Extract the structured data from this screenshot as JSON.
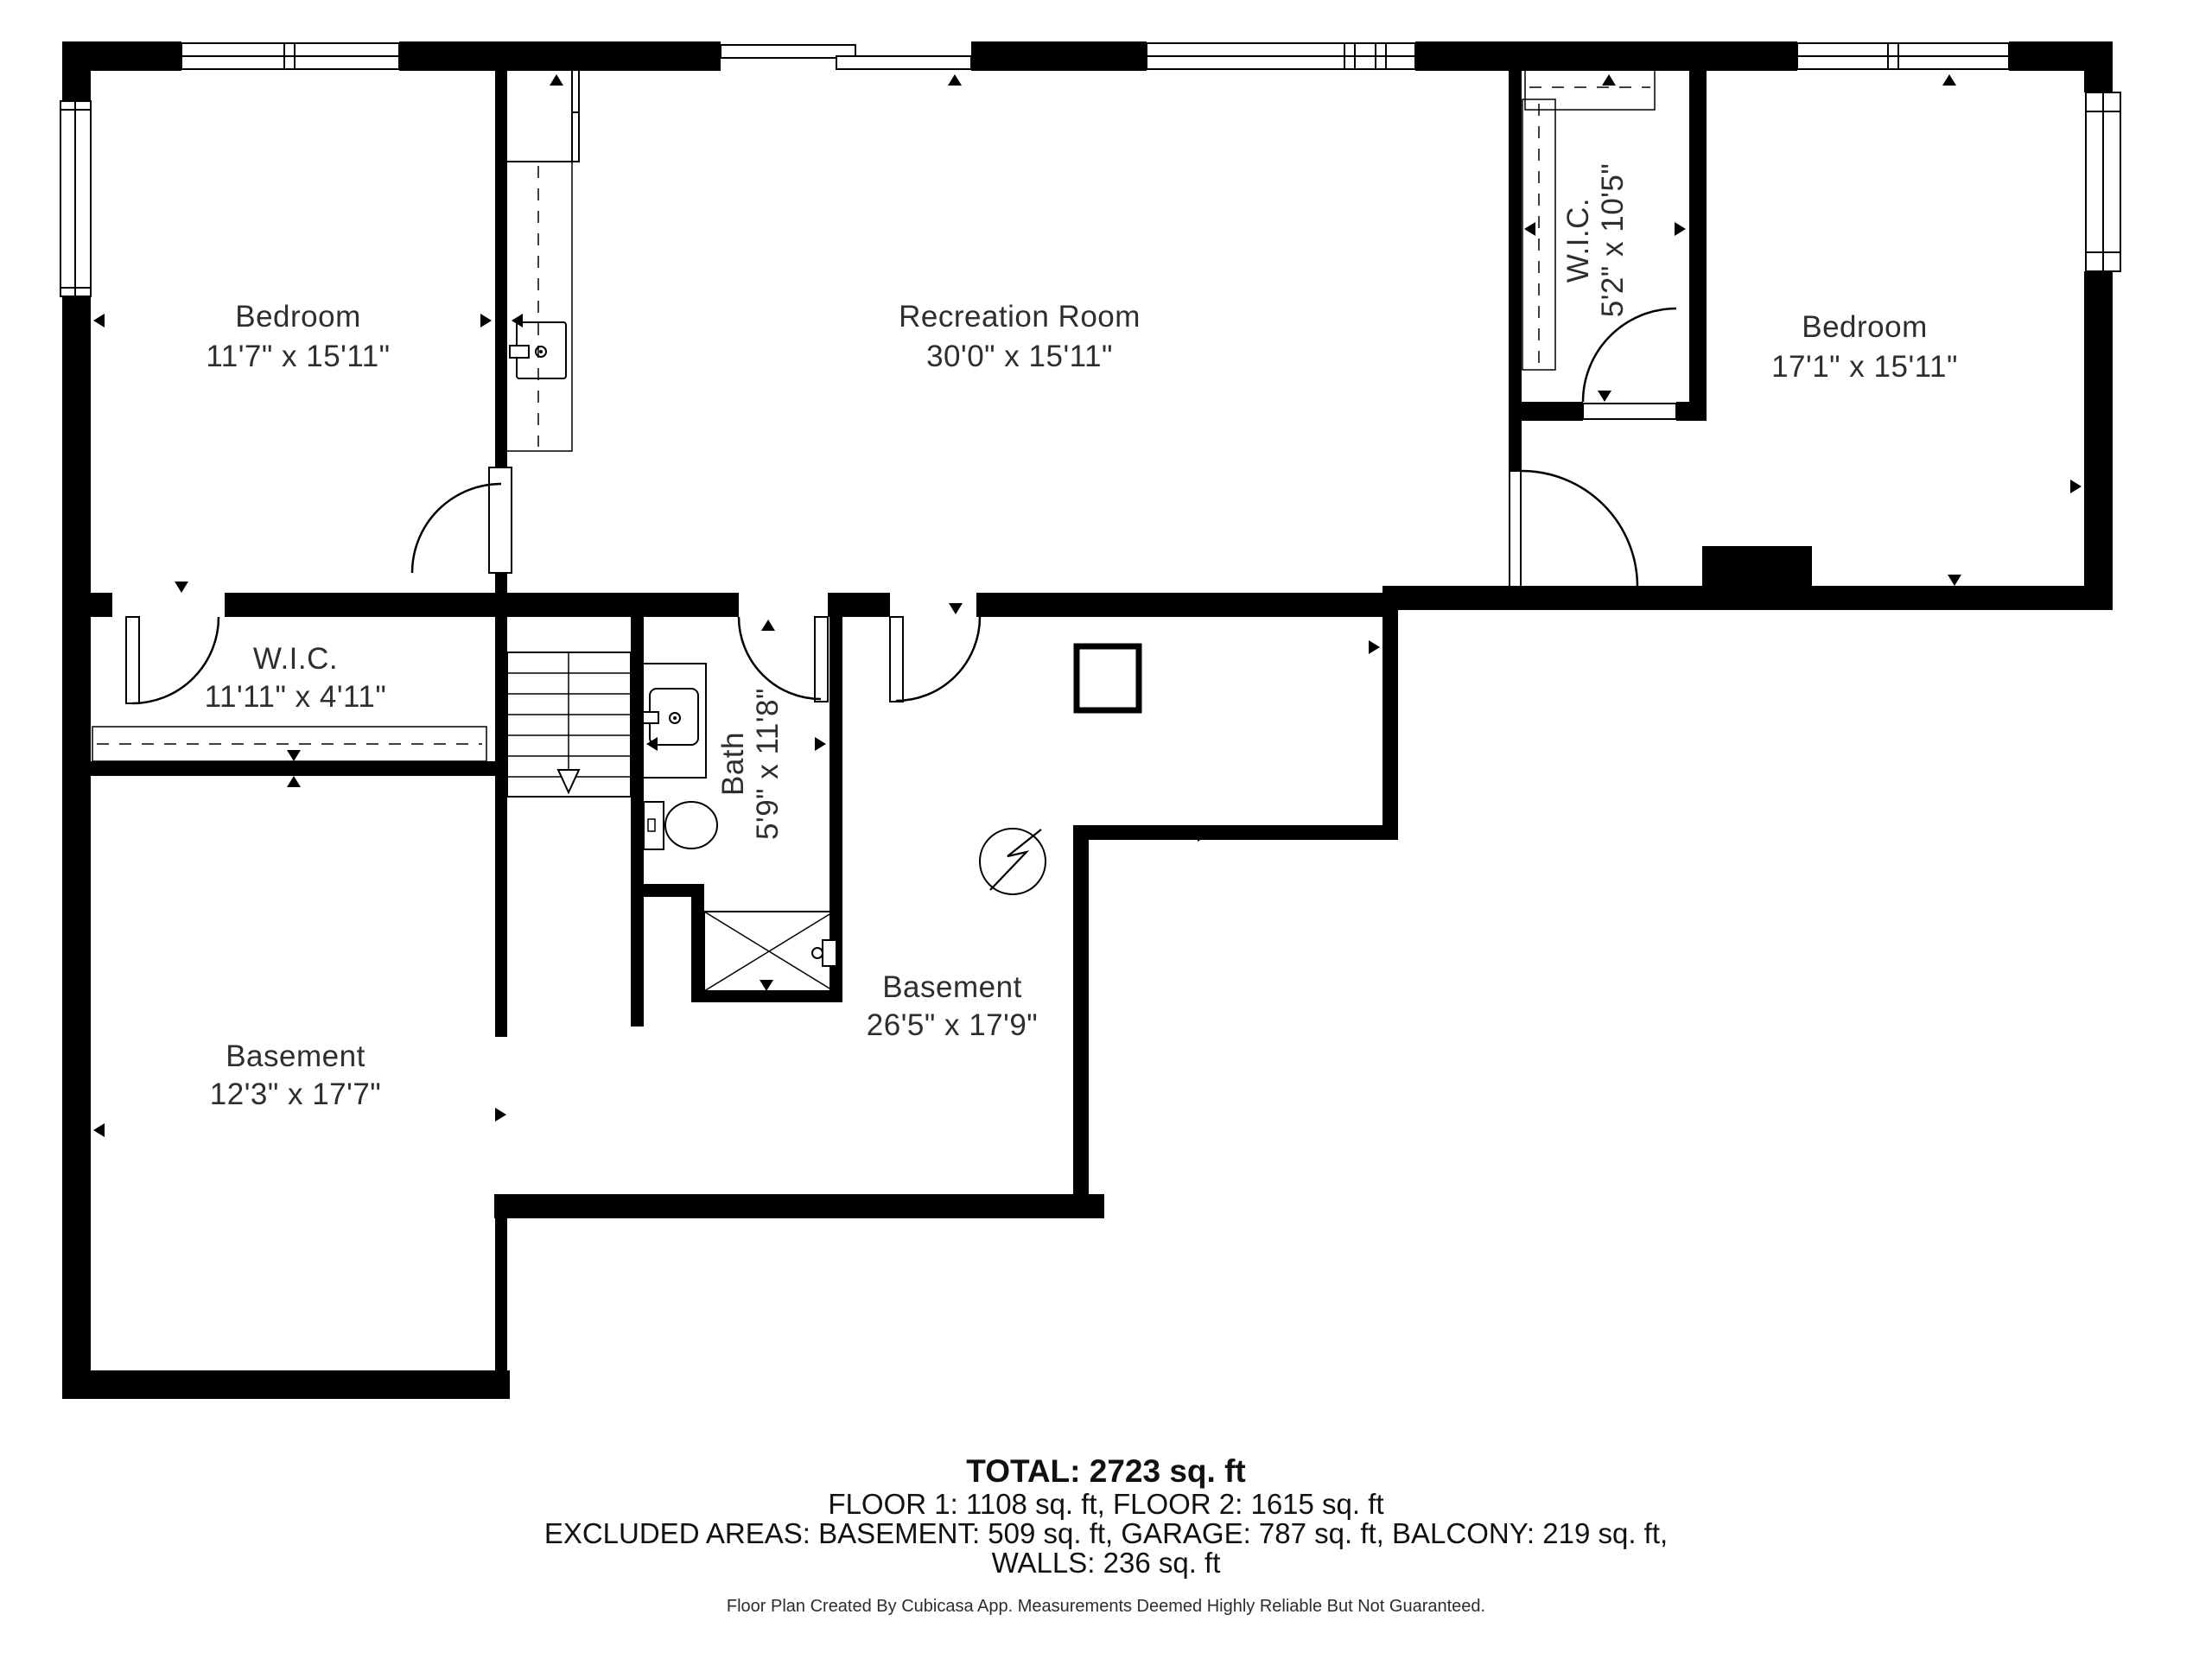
{
  "colors": {
    "wall": "#000000",
    "label_text": "#2e2e2e",
    "background": "#ffffff"
  },
  "rooms": [
    {
      "id": "bedroom-left",
      "name": "Bedroom",
      "dims": "11'7\" x 15'11\""
    },
    {
      "id": "recreation-room",
      "name": "Recreation Room",
      "dims": "30'0\" x 15'11\""
    },
    {
      "id": "wic-upper",
      "name": "W.I.C.",
      "dims": "5'2\" x 10'5\""
    },
    {
      "id": "bedroom-right",
      "name": "Bedroom",
      "dims": "17'1\" x 15'11\""
    },
    {
      "id": "wic-left",
      "name": "W.I.C.",
      "dims": "11'11\" x 4'11\""
    },
    {
      "id": "bath",
      "name": "Bath",
      "dims": "5'9\" x 11'8\""
    },
    {
      "id": "basement-main",
      "name": "Basement",
      "dims": "26'5\" x 17'9\""
    },
    {
      "id": "basement-left",
      "name": "Basement",
      "dims": "12'3\" x 17'7\""
    }
  ],
  "summary": {
    "total": "TOTAL: 2723 sq. ft",
    "floors": "FLOOR 1: 1108 sq. ft, FLOOR 2: 1615 sq. ft",
    "excluded": "EXCLUDED AREAS: BASEMENT: 509 sq. ft, GARAGE: 787 sq. ft, BALCONY: 219 sq. ft,",
    "walls": "WALLS: 236 sq. ft"
  },
  "footer": "Floor Plan Created By Cubicasa App. Measurements Deemed Highly Reliable But Not Guaranteed."
}
